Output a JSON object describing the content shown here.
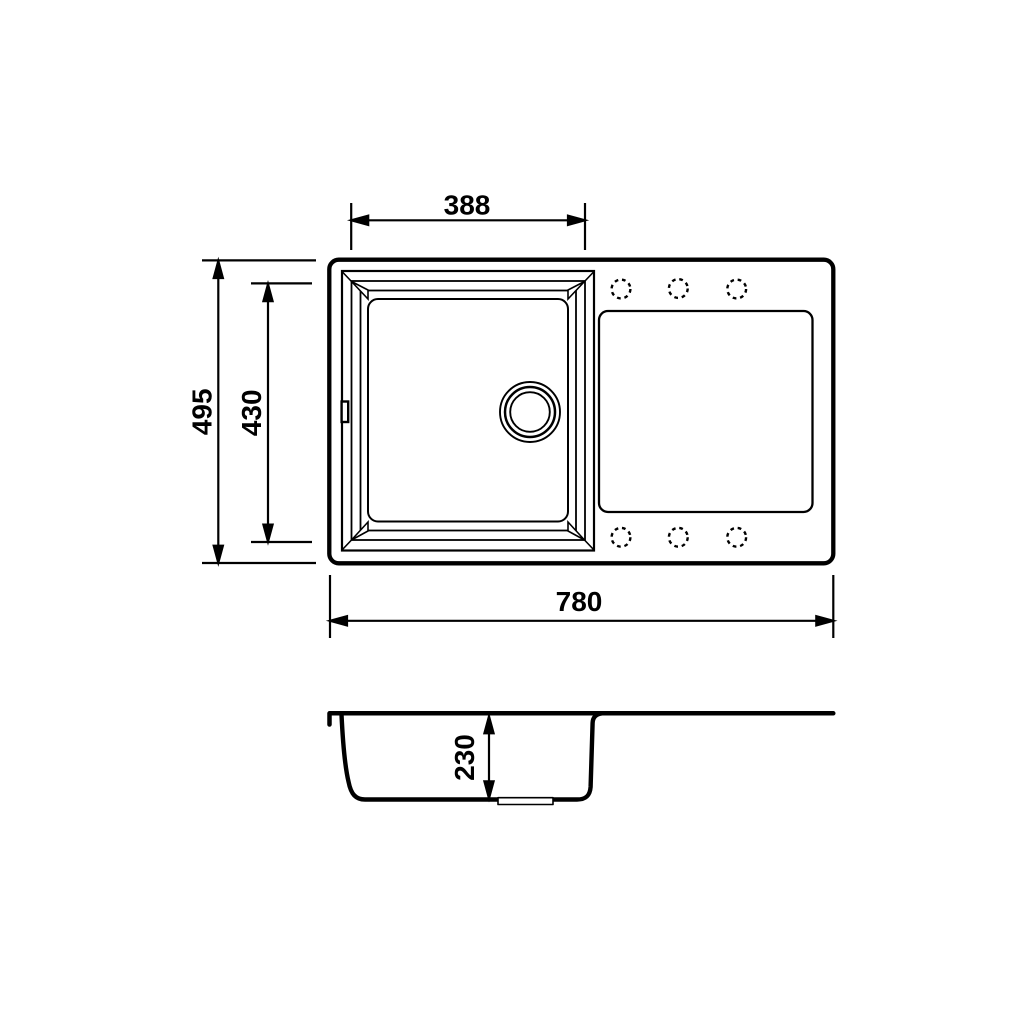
{
  "drawing": {
    "background_color": "#ffffff",
    "line_color": "#000000",
    "views": {
      "top": {
        "name": "sink-top-view",
        "features": [
          "sink-outline",
          "bowl-beveled-rim",
          "overflow-slot",
          "drain-outlet",
          "drainboard",
          "tap-hole-markers"
        ],
        "tap_hole_count": 6,
        "dimensions": {
          "bowl_width": {
            "label": "388"
          },
          "overall_depth": {
            "label": "495"
          },
          "bowl_depth": {
            "label": "430"
          },
          "overall_width": {
            "label": "780"
          }
        }
      },
      "section": {
        "name": "sink-section-view",
        "features": [
          "rim-profile",
          "bowl-profile",
          "drain-recess",
          "drainboard-surface"
        ],
        "dimensions": {
          "bowl_height": {
            "label": "230"
          }
        }
      }
    }
  }
}
